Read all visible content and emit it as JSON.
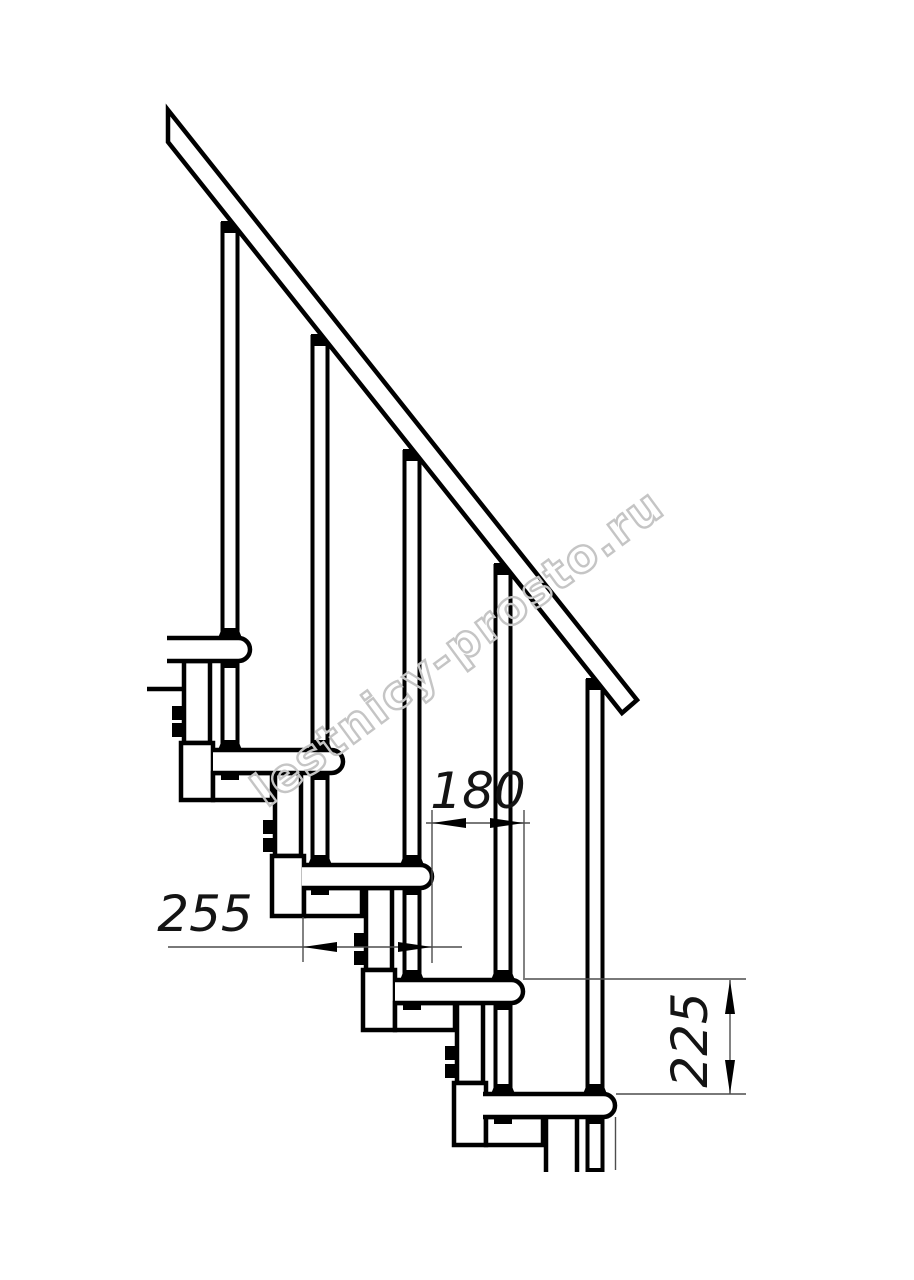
{
  "drawing": {
    "type": "modular-staircase-side-view",
    "watermark": "lestnicy-prosto.ru",
    "dimensions": {
      "tread_depth": "255",
      "step_run": "180",
      "step_rise": "225"
    },
    "visible_counts": {
      "treads": 5,
      "balusters": 5,
      "support_modules": 5
    },
    "colors": {
      "line": "#000000",
      "dimension_line": "#4d4d4d",
      "dimension_text": "#141414",
      "watermark": "#c5c5c5",
      "background": "#ffffff"
    }
  }
}
